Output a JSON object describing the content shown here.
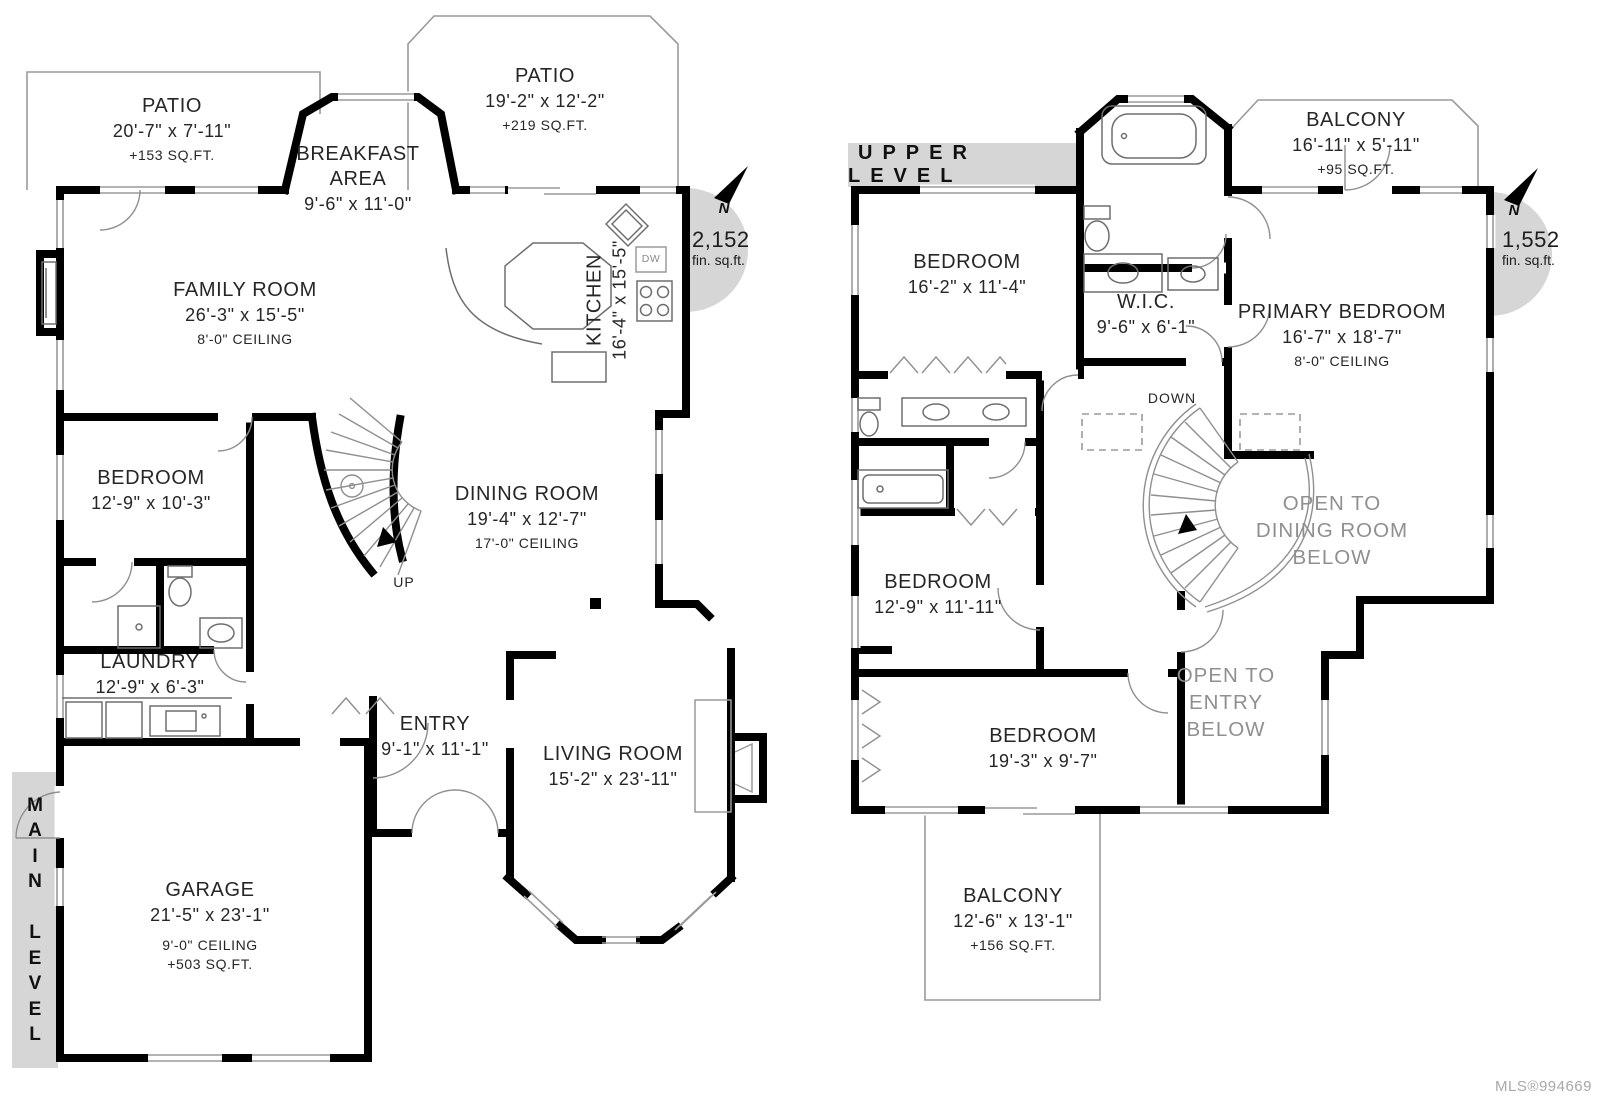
{
  "page": {
    "mls": "MLS®994669"
  },
  "main_level": {
    "banner_vertical": "M\nA\nI\nN\n\nL\nE\nV\nE\nL",
    "area_value": "2,152",
    "area_unit": "fin. sq.ft.",
    "north_label": "N",
    "labels": {
      "up": "UP",
      "dw": "DW"
    },
    "rooms": {
      "patio1": {
        "name": "PATIO",
        "dims": "20'-7\" x 7'-11\"",
        "note": "+153 SQ.FT."
      },
      "breakfast": {
        "name": "BREAKFAST\nAREA",
        "dims": "9'-6\" x 11'-0\""
      },
      "patio2": {
        "name": "PATIO",
        "dims": "19'-2\" x 12'-2\"",
        "note": "+219 SQ.FT."
      },
      "family": {
        "name": "FAMILY ROOM",
        "dims": "26'-3\" x 15'-5\"",
        "note": "8'-0\" CEILING"
      },
      "kitchen": {
        "name": "KITCHEN",
        "dims": "16'-4\" x 15'-5\""
      },
      "bedroom": {
        "name": "BEDROOM",
        "dims": "12'-9\" x 10'-3\""
      },
      "dining": {
        "name": "DINING ROOM",
        "dims": "19'-4\" x 12'-7\"",
        "note": "17'-0\" CEILING"
      },
      "laundry": {
        "name": "LAUNDRY",
        "dims": "12'-9\" x 6'-3\""
      },
      "entry": {
        "name": "ENTRY",
        "dims": "9'-1\" x 11'-1\""
      },
      "living": {
        "name": "LIVING ROOM",
        "dims": "15'-2\" x 23'-11\""
      },
      "garage": {
        "name": "GARAGE",
        "dims": "21'-5\" x 23'-1\"",
        "note": "9'-0\" CEILING",
        "note2": "+503 SQ.FT."
      }
    }
  },
  "upper_level": {
    "banner": "UPPER LEVEL",
    "area_value": "1,552",
    "area_unit": "fin. sq.ft.",
    "north_label": "N",
    "labels": {
      "down": "DOWN"
    },
    "rooms": {
      "bedroom1": {
        "name": "BEDROOM",
        "dims": "16'-2\" x 11'-4\""
      },
      "wic": {
        "name": "W.I.C.",
        "dims": "9'-6\" x 6'-1\""
      },
      "balcony1": {
        "name": "BALCONY",
        "dims": "16'-11\" x 5'-11\"",
        "note": "+95 SQ.FT."
      },
      "primary": {
        "name": "PRIMARY BEDROOM",
        "dims": "16'-7\" x 18'-7\"",
        "note": "8'-0\" CEILING"
      },
      "bedroom2": {
        "name": "BEDROOM",
        "dims": "12'-9\" x 11'-11\""
      },
      "bedroom3": {
        "name": "BEDROOM",
        "dims": "19'-3\" x 9'-7\""
      },
      "balcony2": {
        "name": "BALCONY",
        "dims": "12'-6\" x 13'-1\"",
        "note": "+156 SQ.FT."
      },
      "open_dining": {
        "name": "OPEN TO\nDINING ROOM\nBELOW"
      },
      "open_entry": {
        "name": "OPEN TO\nENTRY\nBELOW"
      }
    }
  }
}
